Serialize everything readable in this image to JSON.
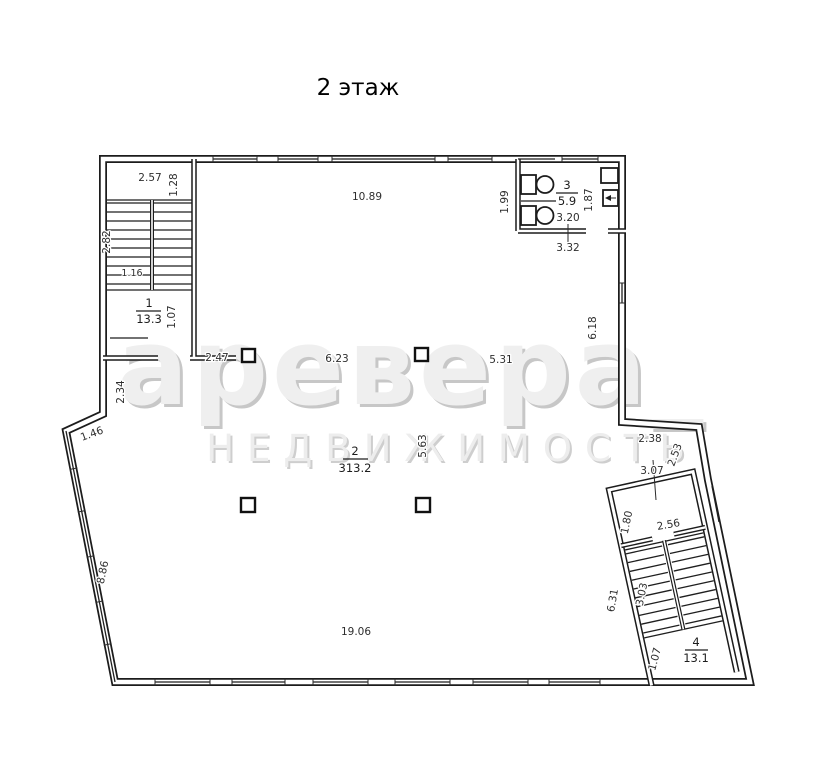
{
  "title": "2 этаж",
  "watermark": {
    "brand": "аревера_",
    "caption": "НЕДВИЖИМОСТЬ"
  },
  "rooms": [
    {
      "number": "1",
      "area": "13.3"
    },
    {
      "number": "2",
      "area": "313.2"
    },
    {
      "number": "3",
      "area": "5.9"
    },
    {
      "number": "4",
      "area": "13.1"
    }
  ],
  "dims": {
    "stair1_width": "2.57",
    "stair1_landing": "1.28",
    "stair1_flight": "2.82",
    "stair1_inner": "1.16",
    "stair1_exit": "1.07",
    "stair1_to_column": "2.47",
    "hall_top": "10.89",
    "wc_depth": "1.99",
    "wc_width": "3.20",
    "wc_right": "1.87",
    "wc_bottom": "3.32",
    "right_wall": "6.18",
    "column_span_1": "6.23",
    "column_span_2": "5.31",
    "left_upper": "2.34",
    "left_notch": "1.46",
    "left_slant": "8.86",
    "hall_mid": "5.63",
    "bottom": "19.06",
    "right_offset": "2.38",
    "right_slant": "2.53",
    "stair4_top": "3.07",
    "stair4_vest_depth": "1.80",
    "stair4_vest_width": "2.56",
    "stair4_side": "6.31",
    "stair4_flight": "3.03",
    "stair4_exit": "1.07"
  }
}
